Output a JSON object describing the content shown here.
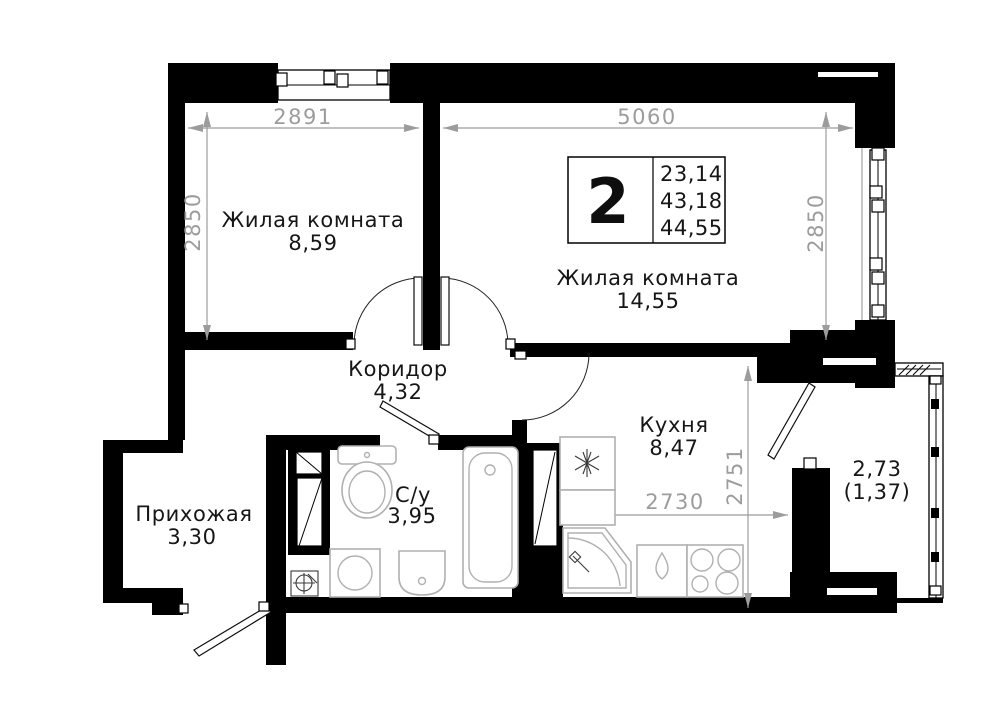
{
  "plan": {
    "info_box": {
      "rooms_count": "2",
      "values": [
        "23,14",
        "43,18",
        "44,55"
      ]
    },
    "rooms": {
      "living1": {
        "name": "Жилая комната",
        "area": "8,59"
      },
      "living2": {
        "name": "Жилая комната",
        "area": "14,55"
      },
      "corridor": {
        "name": "Коридор",
        "area": "4,32"
      },
      "kitchen": {
        "name": "Кухня",
        "area": "8,47"
      },
      "hallway": {
        "name": "Прихожая",
        "area": "3,30"
      },
      "bathroom": {
        "name": "С/у",
        "area": "3,95"
      },
      "balcony": {
        "area": "2,73",
        "area_reduced": "(1,37)"
      }
    },
    "dimensions": {
      "top_left": "2891",
      "top_right": "5060",
      "left": "2850",
      "right": "2850",
      "kitchen_width": "2730",
      "kitchen_height": "2751"
    },
    "fixture_icons": [
      "ventilation-shaft",
      "toilet",
      "washing-machine",
      "washbasin",
      "bathtub",
      "floor-drain",
      "refrigerator",
      "corner-sink",
      "kitchen-sink",
      "stove"
    ],
    "colors": {
      "wall": "#000000",
      "dimension": "#9c9c9c",
      "fixture": "#b0b0b0",
      "background": "#ffffff"
    }
  }
}
